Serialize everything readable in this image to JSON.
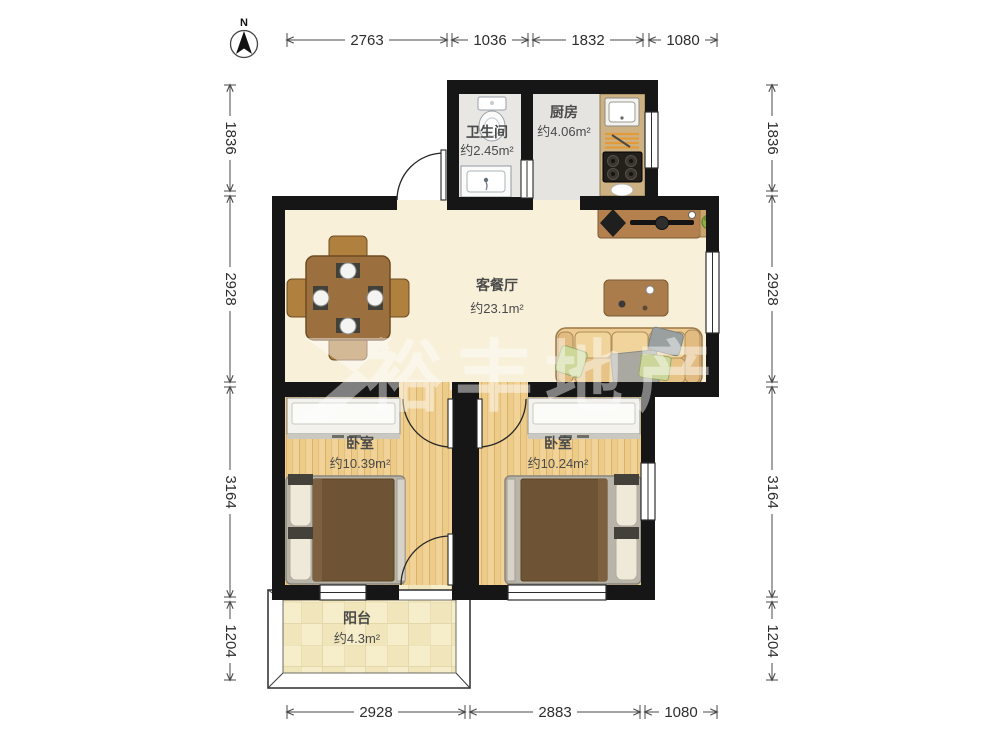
{
  "compass": {
    "label": "N"
  },
  "watermark": {
    "text": "裕丰地产"
  },
  "rooms": [
    {
      "id": "bathroom",
      "name": "卫生间",
      "area": "约2.45m²"
    },
    {
      "id": "kitchen",
      "name": "厨房",
      "area": "约4.06m²"
    },
    {
      "id": "living-dining",
      "name": "客餐厅",
      "area": "约23.1m²"
    },
    {
      "id": "bedroom-left",
      "name": "卧室",
      "area": "约10.39m²"
    },
    {
      "id": "bedroom-right",
      "name": "卧室",
      "area": "约10.24m²"
    },
    {
      "id": "balcony",
      "name": "阳台",
      "area": "约4.3m²"
    }
  ],
  "dims": {
    "top": [
      "2763",
      "1036",
      "1832",
      "1080"
    ],
    "bottom": [
      "2928",
      "2883",
      "1080"
    ],
    "left": [
      "1836",
      "2928",
      "3164",
      "1204"
    ],
    "right": [
      "1836",
      "2928",
      "3164",
      "1204"
    ]
  },
  "colors": {
    "wall": "#161616",
    "living_floor": "#f8f0d9",
    "wood_floor": "#f2d397",
    "tile_floor": "#f6eecb",
    "wet_floor": "#e8e7e4",
    "counter": "#cdb183",
    "furniture_wood": "#9c6f3e",
    "sofa": "#ecca90",
    "bed_blanket": "#6e5434",
    "plant": "#7fa23f"
  }
}
